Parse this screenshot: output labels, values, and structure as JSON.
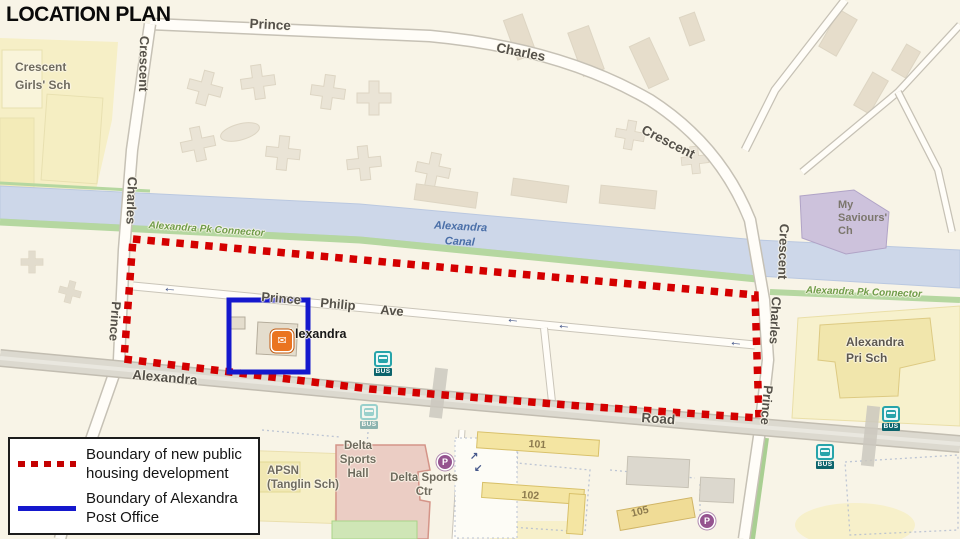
{
  "title": "LOCATION PLAN",
  "legend": {
    "items": [
      {
        "label": "Boundary of new public\nhousing development",
        "swatch": "red-dotted",
        "color": "#c40000"
      },
      {
        "label": "Boundary of Alexandra\nPost Office",
        "swatch": "blue-solid",
        "color": "#1518cd"
      }
    ]
  },
  "map": {
    "labels": {
      "crescent_girls_sch": "Crescent\nGirls' Sch",
      "road_top_prince": "Prince",
      "road_top_charles": "Charles",
      "road_top_crescent": "Crescent",
      "road_left_crescent": "Crescent",
      "road_left_charles": "Charles",
      "road_left_prince": "Prince",
      "road_right_crescent": "Crescent",
      "road_right_charles": "Charles",
      "road_right_prince": "Prince",
      "canal": "Alexandra Canal",
      "pk_connector_left": "Alexandra Pk Connector",
      "pk_connector_right": "Alexandra Pk Connector",
      "my_saviours_ch": "My\nSaviours'\nCh",
      "alexandra_pri_sch": "Alexandra\nPri Sch",
      "ppa_prince": "Prince",
      "ppa_philip": "Philip",
      "ppa_ave": "Ave",
      "post_office": "Alexandra",
      "alexandra_road_left": "Alexandra",
      "alexandra_road_right": "Road",
      "apsn": "APSN\n(Tanglin Sch)",
      "delta_sports_hall": "Delta\nSports\nHall",
      "delta_sports_ctr": "Delta Sports\nCtr",
      "block_101": "101",
      "block_102": "102",
      "block_105": "105"
    },
    "icons": {
      "bus_label": "BUS",
      "parking_label": "P",
      "post_office_glyph": "✉"
    },
    "glyphs": {
      "arrow_left": "←",
      "arrow_ne": "↗",
      "arrow_sw": "↙"
    },
    "colors": {
      "boundary_red": "#d40000",
      "boundary_blue": "#1518cd",
      "canal_blue": "#cdd7e9",
      "greenway_green": "#b5d7a0",
      "bus_teal": "#27a4aa",
      "parking_purple": "#95538f",
      "post_office_orange": "#ea7420"
    }
  }
}
